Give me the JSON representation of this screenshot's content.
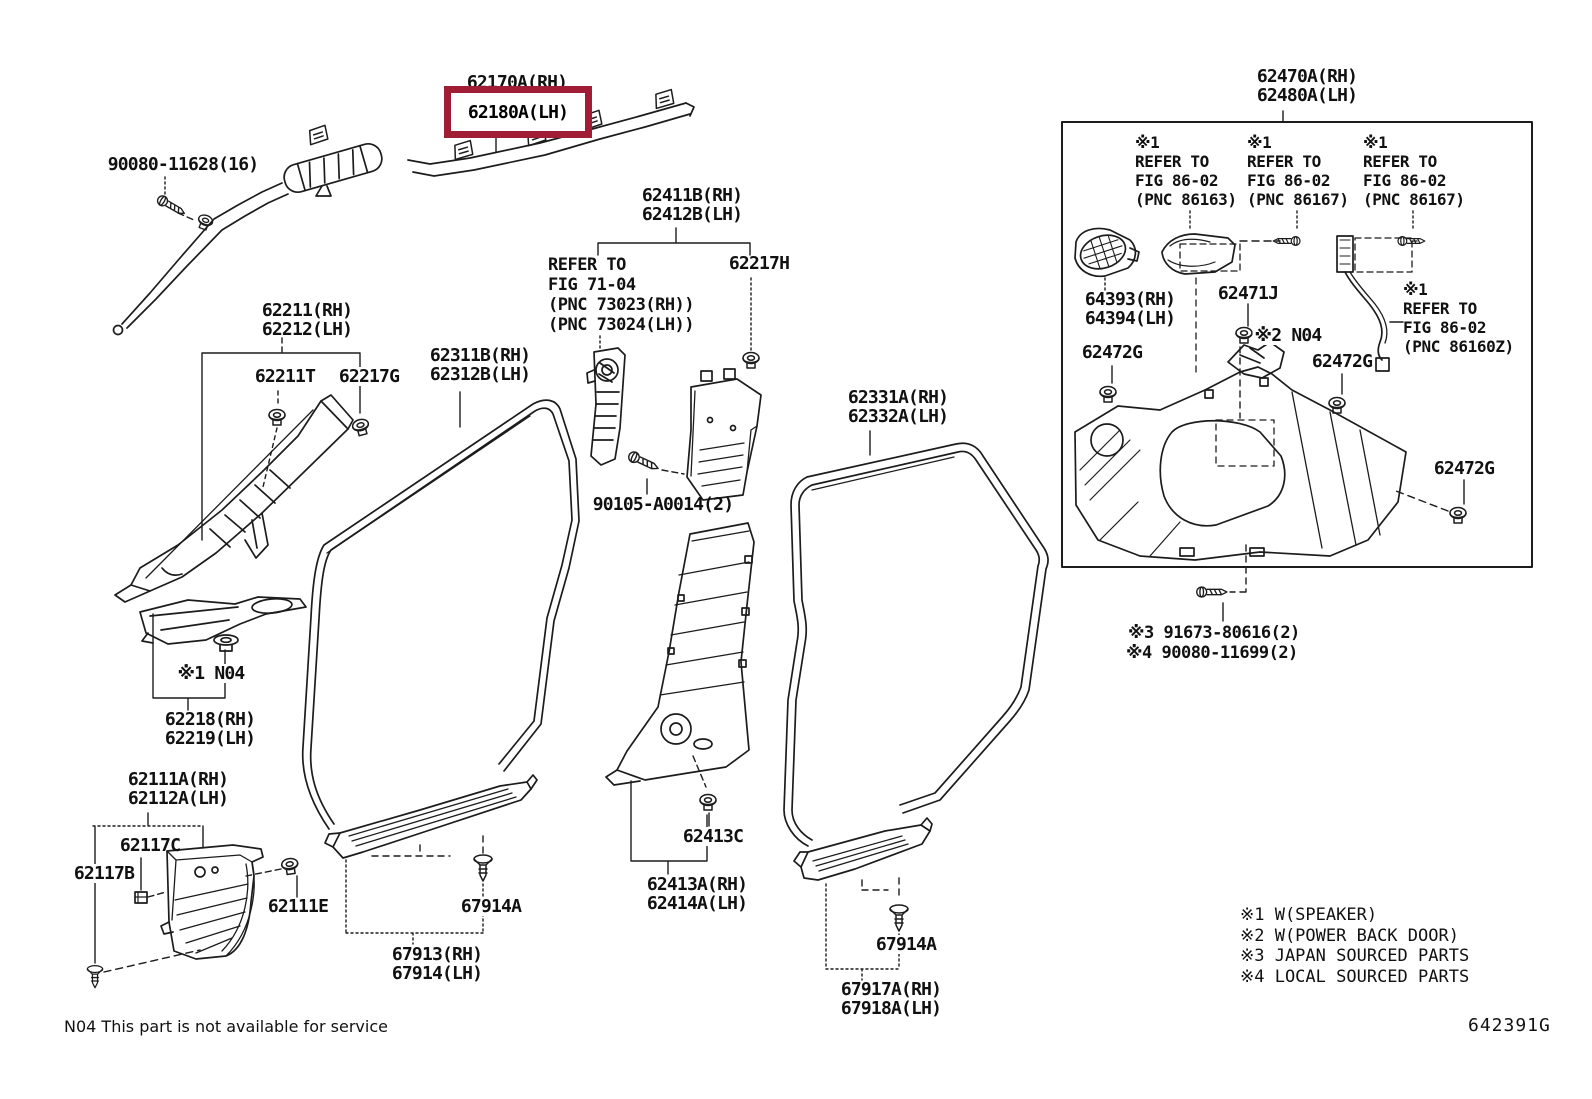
{
  "figure": {
    "code": "642391G",
    "service_note": "N04 This part is not available for service",
    "highlight_color": "#A01D35",
    "line_color": "#1c1c1c"
  },
  "legend": {
    "item1": "※1 W(SPEAKER)",
    "item2": "※2 W(POWER BACK DOOR)",
    "item3": "※3 JAPAN SOURCED PARTS",
    "item4": "※4 LOCAL SOURCED PARTS"
  },
  "labels": {
    "p90080_11628": "90080-11628(16)",
    "p62170A": "62170A(RH)",
    "p62180A": "62180A(LH)",
    "p62211": "62211(RH)",
    "p62212": "62212(LH)",
    "p62211T": "62211T",
    "p62217G": "62217G",
    "p62311B": "62311B(RH)",
    "p62312B": "62312B(LH)",
    "p62411B": "62411B(RH)",
    "p62412B": "62412B(LH)",
    "p62217H": "62217H",
    "p90105": "90105-A0014(2)",
    "p62331A": "62331A(RH)",
    "p62332A": "62332A(LH)",
    "n04_a": "※1 N04",
    "p62218": "62218(RH)",
    "p62219": "62219(LH)",
    "p62111A": "62111A(RH)",
    "p62112A": "62112A(LH)",
    "p62117C": "62117C",
    "p62117B": "62117B",
    "p62111E": "62111E",
    "p67914A_front": "67914A",
    "p67913": "67913(RH)",
    "p67914": "67914(LH)",
    "p62413C": "62413C",
    "p62413A": "62413A(RH)",
    "p62414A": "62414A(LH)",
    "p67914A_rear": "67914A",
    "p67917A": "67917A(RH)",
    "p67918A": "67918A(LH)",
    "p62470A": "62470A(RH)",
    "p62480A": "62480A(LH)",
    "p64393": "64393(RH)",
    "p64394": "64394(LH)",
    "p62471J": "62471J",
    "n04_b": "※2 N04",
    "p62472G_a": "62472G",
    "p62472G_b": "62472G",
    "p62472G_c": "62472G",
    "fastener3": "※3 91673-80616(2)",
    "fastener4": "※4 90080-11699(2)"
  },
  "refs": {
    "fig7104": {
      "line1": "REFER TO",
      "line2": "FIG 71-04",
      "line3": "(PNC 73023(RH))",
      "line4": "(PNC 73024(LH))"
    },
    "fig8602_1": {
      "mark": "※1",
      "line1": "REFER TO",
      "line2": "FIG 86-02",
      "line3": "(PNC 86163)"
    },
    "fig8602_2": {
      "mark": "※1",
      "line1": "REFER TO",
      "line2": "FIG 86-02",
      "line3": "(PNC 86167)"
    },
    "fig8602_3": {
      "mark": "※1",
      "line1": "REFER TO",
      "line2": "FIG 86-02",
      "line3": "(PNC 86167)"
    },
    "fig8602_4": {
      "mark": "※1",
      "line1": "REFER TO",
      "line2": "FIG 86-02",
      "line3": "(PNC 86160Z)"
    }
  }
}
